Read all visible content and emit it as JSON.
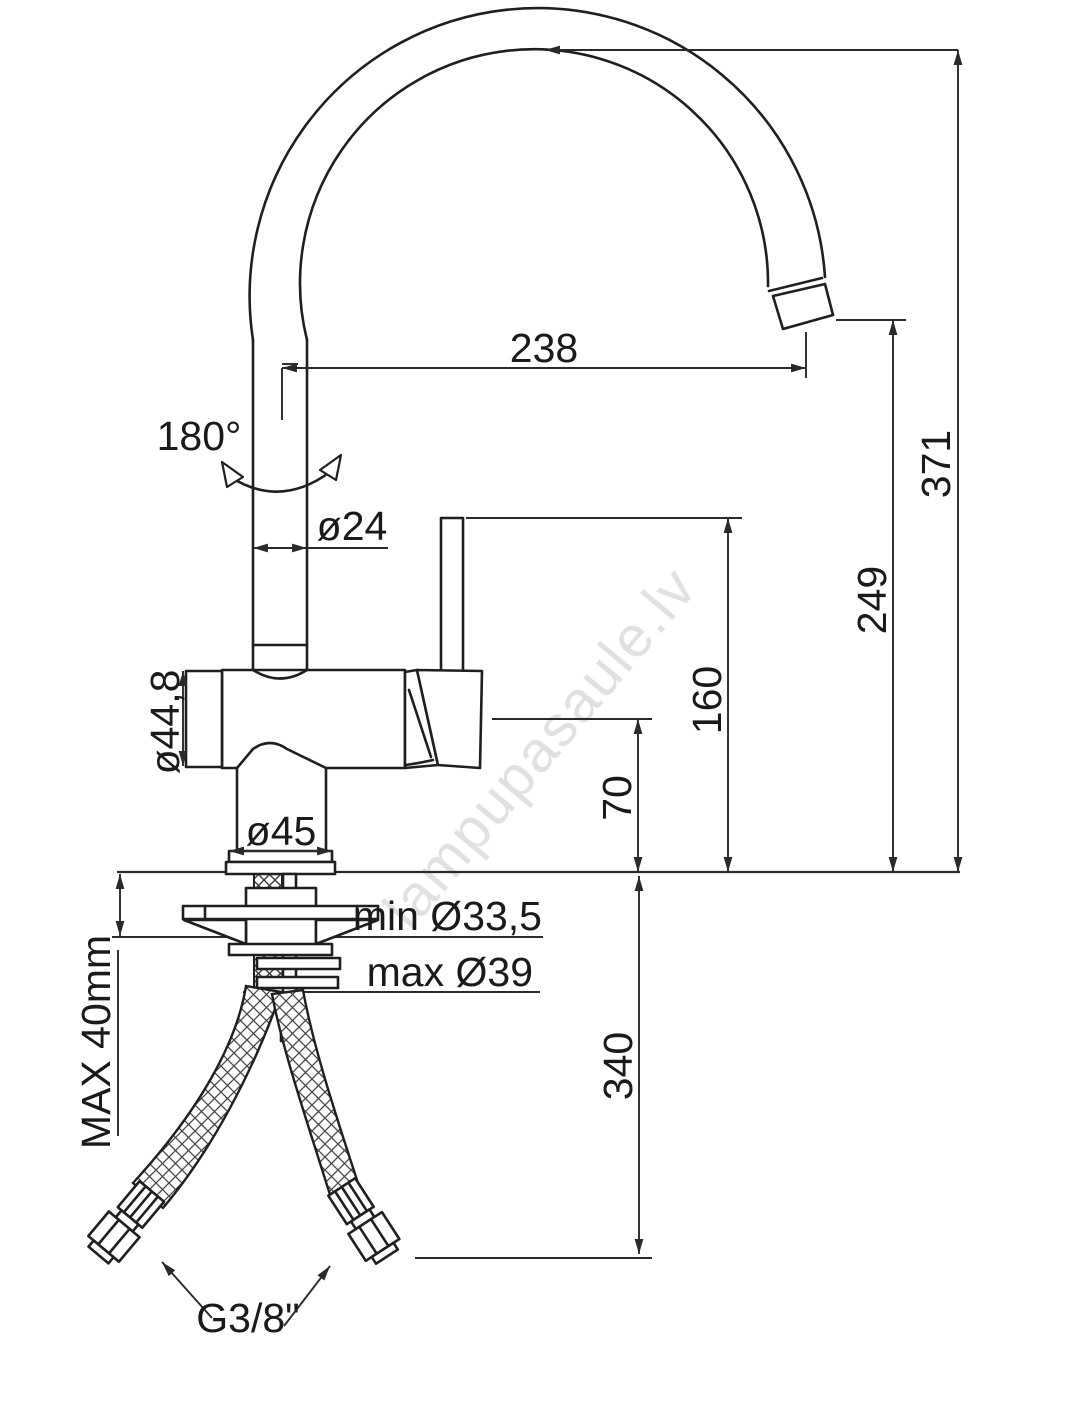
{
  "colors": {
    "background": "#ffffff",
    "line": "#1f1f1f",
    "dim": "#2a2a2a",
    "text": "#1a1a1a",
    "watermark": "#c9c9c9"
  },
  "watermark": {
    "text": "lampupasaule.lv"
  },
  "dims": {
    "reach": "238",
    "height_total": "371",
    "height_spout": "249",
    "height_handle": "160",
    "height_body": "70",
    "hose_length": "340",
    "swivel": "180°",
    "spout_dia": "ø24",
    "body_dia": "ø44,8",
    "base_dia": "ø45",
    "hole_min": "min Ø33,5",
    "hole_max": "max Ø39",
    "deck_max": "MAX 40mm",
    "thread": "G3/8\""
  }
}
